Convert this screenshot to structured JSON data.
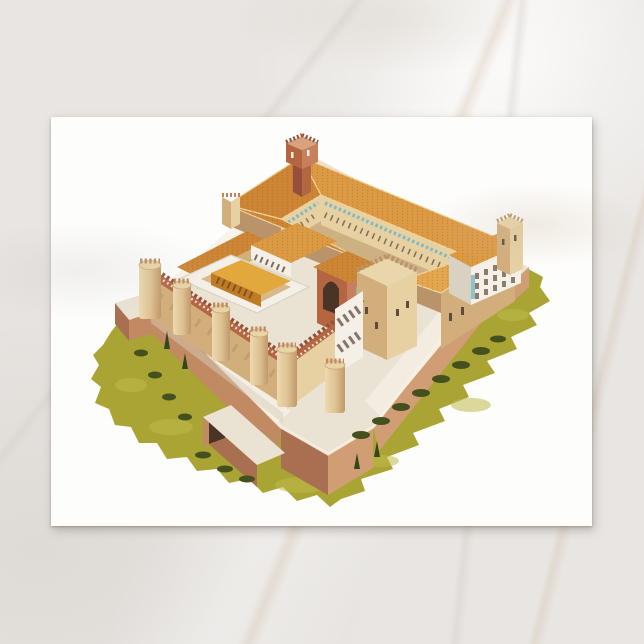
{
  "scene": {
    "description": "White postcard lying on a light marble surface, seen from directly above",
    "background": {
      "name": "marble-surface",
      "base": "#e8e5e2",
      "vein": "#d3ccc4",
      "warm_vein": "#d8c5b0",
      "light": "#f3f1ef"
    },
    "postcard": {
      "name": "postcard",
      "color": "#fdfdfc",
      "shadow": "rgba(105,98,88,0.38)"
    }
  },
  "illustration": {
    "subject": "aerial-isometric-illustration-of-fortified-brick-palace-with-round-towers-tiled-courtyard-ranges-bastioned-outer-walls-and-grass",
    "palette": {
      "roof": "#dd9a44",
      "roof_dark": "#cd8636",
      "roof_light": "#e4a750",
      "roof_edge": "#f2d49a",
      "wall_tan": "#e7d0a2",
      "wall_tan_dark": "#d2ae7c",
      "wall_tan_shadow": "#b9946a",
      "brick": "#b46542",
      "brick_dark": "#96503a",
      "brick_light": "#c8805c",
      "terrace": "#eae2d3",
      "terrace_light": "#f6f1e6",
      "terrace_shadow": "#d8cdbb",
      "outer_wall": "#c18a63",
      "outer_wall_dark": "#a87050",
      "outer_wall_light": "#d09d75",
      "grass": "#a9a433",
      "grass_light": "#c0bb4c",
      "bush": "#44511e",
      "tree": "#33471c",
      "teal": "#7fb9c4",
      "window": "#5d4c3c",
      "white_wall": "#f4f0e8",
      "white_shadow": "#d9d2c2",
      "gold": "#c07a22",
      "gold_light": "#e2a83c",
      "arch_dark": "#4a3426"
    }
  }
}
